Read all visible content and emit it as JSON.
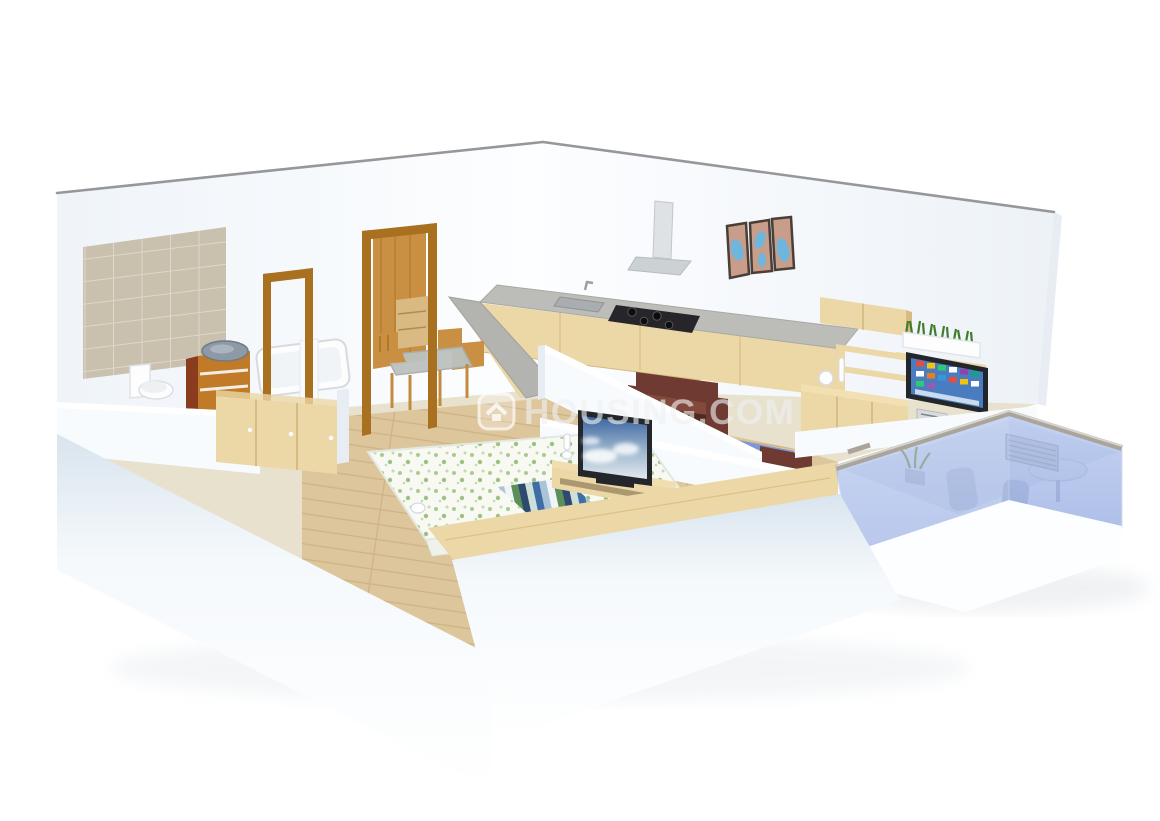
{
  "watermark": {
    "text": "HOUSING.COM",
    "logo_icon": "housing-logo-icon"
  },
  "scene": {
    "type": "3d-isometric-floor-plan-render",
    "rooms": [
      "bathroom",
      "hallway",
      "dining-area",
      "kitchen",
      "living-room",
      "bedroom",
      "balcony"
    ],
    "objects": [
      "tiled-wall",
      "toilet",
      "washbasin-cabinet",
      "bathtub",
      "wardrobe",
      "door-frames",
      "dining-table-set",
      "kitchen-l-counter",
      "gas-stove",
      "kitchen-sink",
      "chimney-hood",
      "wall-art-triptych",
      "wall-cabinet",
      "floating-shelves",
      "planter-box",
      "wall-tv",
      "tv-sideboard",
      "media-player",
      "leather-armchair",
      "blue-sofa",
      "double-bed",
      "striped-bed-runner",
      "bedroom-tv",
      "bedroom-tv-unit",
      "headboard-plank",
      "glass-railing",
      "ac-unit",
      "balcony-table-chairs",
      "balcony-plant"
    ]
  },
  "colors": {
    "background": "#ffffff",
    "wall-white": "#f8fbfe",
    "wall-shade": "#e7edf3",
    "wall-cap": "#95979a",
    "tile-beige": "#c9c0ae",
    "tile-grout": "#ded8ca",
    "floor-beige": "#e7e1ce",
    "floor-wood": "#ddc69c",
    "wood-light": "#ecd7a6",
    "wood-mid": "#d9ba82",
    "wood-door": "#c98f42",
    "wood-door-dark": "#a9701f",
    "counter-gray": "#bcbcb8",
    "stove-black": "#26262a",
    "steel-gray": "#cdd2d6",
    "leather-brown": "#6e3a31",
    "leather-dark": "#53281f",
    "sofa-blue": "#7b97d8",
    "glass-blue": "#8fa9e3",
    "rail-gray": "#a9a59c",
    "plant-green": "#3f7d2c",
    "tv-frame": "#23272c",
    "tv-screen-blue": "#4a7dc0",
    "art-frame": "#4a3f38",
    "art-salmon": "#c89d8a",
    "art-blue": "#6fb6dd",
    "ceramic-white": "#fdfdfd",
    "watermark-white": "#eff1f2"
  }
}
